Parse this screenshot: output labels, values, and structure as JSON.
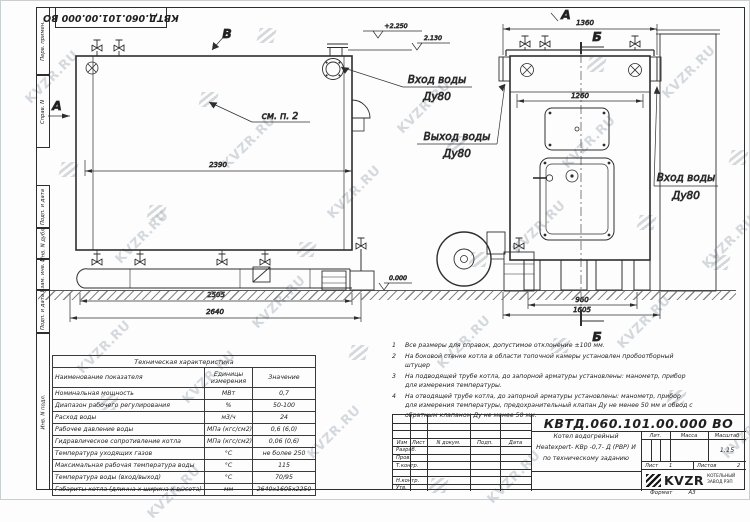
{
  "page": {
    "watermark_text": "KVZR.RU",
    "doc_number": "КВТД.060.101.00.000 ВО",
    "format_label": "Формат",
    "format_value": "А3"
  },
  "margin_labels": [
    "Перв. примен.",
    "Справ. N",
    "Подп. и дата",
    "Инв. N дубл.",
    "Взам. инв. N",
    "Подп. и дата",
    "Инв. N подл."
  ],
  "side_view": {
    "view_marker": "В",
    "section_marker": "А",
    "see_note": "см. п. 2",
    "elev_top": "+2.250",
    "elev_pipe": "2.130",
    "elev_zero": "0.000",
    "dim_body": "2390",
    "dim_skid": "2505",
    "dim_overall": "2640",
    "inlet_label": "Вход воды",
    "inlet_dn": "Ду80",
    "outlet_label": "Выход воды",
    "outlet_dn": "Ду80"
  },
  "front_view": {
    "view_marker": "А",
    "section_top": "Б",
    "section_bottom": "Б",
    "dim_width": "1360",
    "dim_inner": "1260",
    "dim_feet": "960",
    "dim_base": "1605",
    "inlet_label": "Вход воды",
    "inlet_dn": "Ду80"
  },
  "tech_table": {
    "title": "Техническая характеристика",
    "headers": [
      "Наименование показателя",
      "Единицы измерения",
      "Значение"
    ],
    "rows": [
      [
        "Номинальная мощность",
        "МВт",
        "0,7"
      ],
      [
        "Диапазон рабочего регулирования",
        "%",
        "50-100"
      ],
      [
        "Расход воды",
        "м3/ч",
        "24"
      ],
      [
        "Рабочее давление воды",
        "МПа (кгс/см2)",
        "0,6 (6,0)"
      ],
      [
        "Гидравлическое сопротивление котла",
        "МПа (кгс/см2)",
        "0,06 (0,6)"
      ],
      [
        "Температура уходящих газов",
        "°С",
        "не более 250"
      ],
      [
        "Максимальная рабочая температура воды",
        "°С",
        "115"
      ],
      [
        "Температура воды (вход/выход)",
        "°С",
        "70/95"
      ],
      [
        "Габариты котла (длинна х ширина х высота)",
        "мм",
        "2640х1605х2250"
      ]
    ]
  },
  "notes": [
    {
      "num": "1",
      "text": "Все размеры для справок, допустимое отклонение ±100 мм."
    },
    {
      "num": "2",
      "text": "На боковой стенке котла в области топочной камеры установлен пробоотборный штуцер"
    },
    {
      "num": "3",
      "text": "На подводящей трубе котла, до запорной арматуры установлены: манометр, прибор для измерения температуры."
    },
    {
      "num": "4",
      "text": "На отводящей трубе котла, до запорной арматуры установлены: манометр, прибор для измерения температуры, предохранительный клапан Ду не менее 50 мм и обвод с обратным клапаном Ду не менее 50 мм."
    }
  ],
  "title_block": {
    "doc_number": "КВТД.060.101.00.000 ВО",
    "header_cols": [
      "Изм",
      "Лист",
      "N докум.",
      "Подп.",
      "Дата"
    ],
    "row_labels": [
      "Разраб.",
      "Пров.",
      "Т.контр.",
      "Н.контр.",
      "Утв."
    ],
    "product_lines": [
      "Котел водогрейный",
      "Heatexpert- КВр -0,7- Д (РВР) И",
      "по техническому заданию"
    ],
    "lit_label": "Лит.",
    "mass_label": "Масса",
    "scale_label": "Масштаб",
    "scale_value": "1:15",
    "sheet_label": "Лист",
    "sheet_value": "1",
    "sheets_label": "Листов",
    "sheets_value": "2",
    "logo_text": "KVZR",
    "company_line1": "КОТЕЛЬНЫЙ",
    "company_line2": "ЗАВОД РЭП"
  },
  "colors": {
    "line": "#2e2e2e",
    "watermark": "#b4bcc3"
  }
}
